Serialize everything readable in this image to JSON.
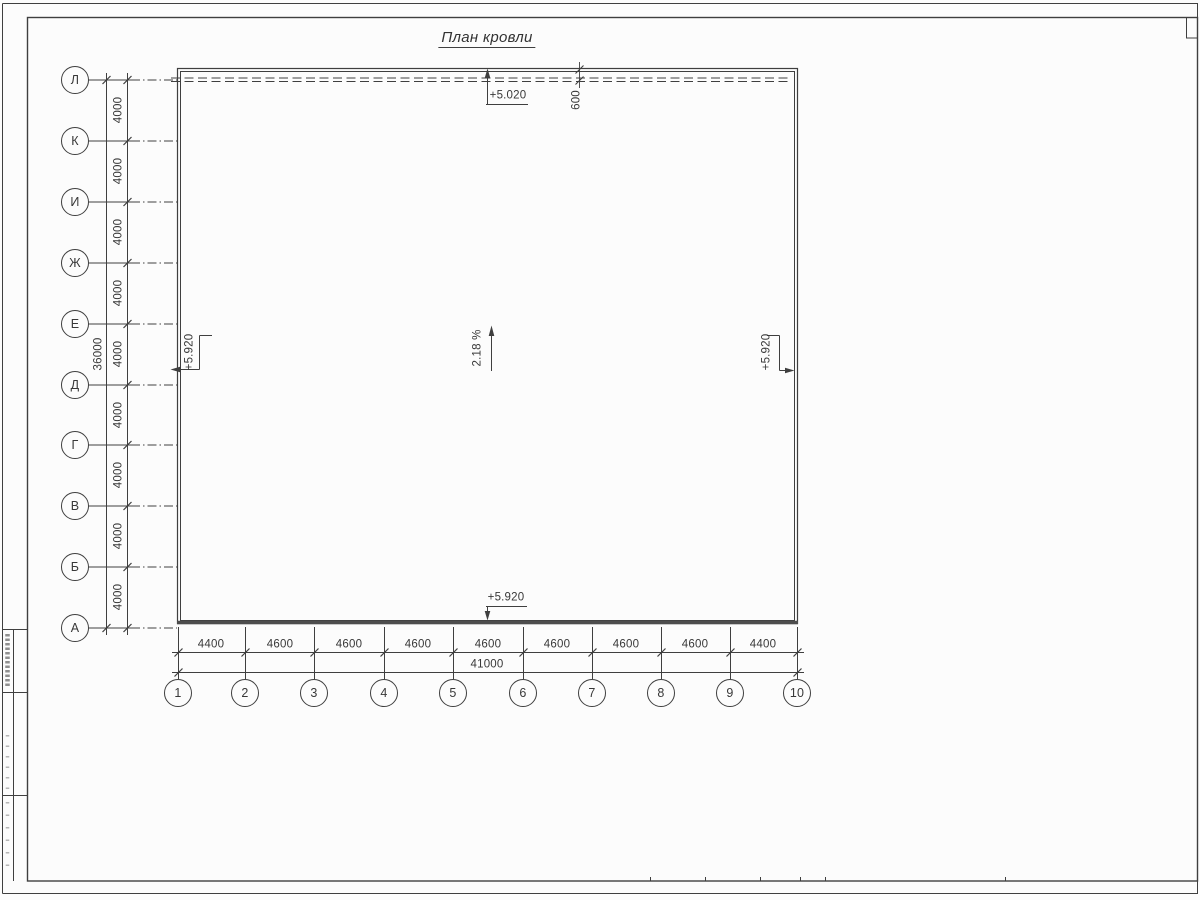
{
  "sheet": {
    "title": "План кровли"
  },
  "grid": {
    "row_axes": [
      "Л",
      "К",
      "И",
      "Ж",
      "Е",
      "Д",
      "Г",
      "В",
      "Б",
      "А"
    ],
    "row_spacings": [
      "4000",
      "4000",
      "4000",
      "4000",
      "4000",
      "4000",
      "4000",
      "4000",
      "4000"
    ],
    "row_total": "36000",
    "col_axes": [
      "1",
      "2",
      "3",
      "4",
      "5",
      "6",
      "7",
      "8",
      "9",
      "10"
    ],
    "col_spacings": [
      "4400",
      "4600",
      "4600",
      "4600",
      "4600",
      "4600",
      "4600",
      "4600",
      "4400"
    ],
    "col_total": "41000"
  },
  "annotations": {
    "roof_edge_elevation": "+5.020",
    "overhang_width": "600",
    "slope": "2.18 %",
    "elevation_left": "+5.920",
    "elevation_right": "+5.920",
    "elevation_bottom": "+5.920"
  },
  "colors": {
    "line": "#3f3f3f",
    "thick_wall": "#4d4d4d",
    "background": "#fcfcfc"
  }
}
